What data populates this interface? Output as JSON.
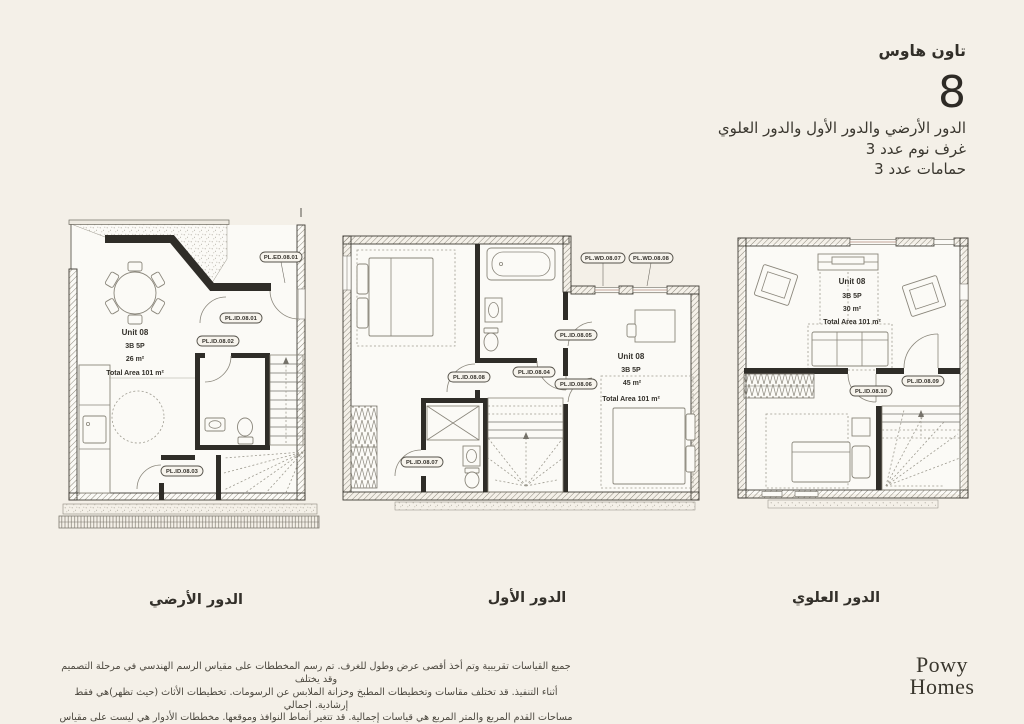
{
  "header": {
    "title": "تاون هاوس",
    "unit_number": "8",
    "floors": "الدور الأرضي والدور الأول والدور العلوي",
    "bedrooms": "غرف نوم عدد 3",
    "bathrooms": "حمامات عدد 3"
  },
  "plans": [
    {
      "label": "الدور الأرضي",
      "unit": "Unit 08",
      "type": "3B 5P",
      "area": "26 m²",
      "total": "Total Area 101 m²",
      "tags": [
        "PL.ED.08.01",
        "PL.ID.08.01",
        "PL.ID.08.02",
        "PL.ID.08.03"
      ]
    },
    {
      "label": "الدور الأول",
      "unit": "Unit 08",
      "type": "3B 5P",
      "area": "45 m²",
      "total": "Total Area 101 m²",
      "tags": [
        "PL.WD.08.07",
        "PL.WD.08.08",
        "PL.ID.08.05",
        "PL.ID.08.04",
        "PL.ID.08.06",
        "PL.ID.08.08",
        "PL.ID.08.07"
      ]
    },
    {
      "label": "الدور العلوي",
      "unit": "Unit 08",
      "type": "3B 5P",
      "area": "30 m²",
      "total": "Total Area 101 m²",
      "tags": [
        "PL.ID.08.09",
        "PL.ID.08.10"
      ]
    }
  ],
  "disclaimer": {
    "line1": "جميع القياسات تقريبية وتم أخذ أقصى عرض وطول للغرف. تم رسم المخططات على مقياس الرسم الهندسي في مرحلة التصميم وقد يختلف",
    "line2": "أثناء التنفيذ. قد تختلف مقاسات وتخطيطات المطبخ وخزانة الملابس عن الرسومات. تخطيطات الأثاث (حيث تظهر)هي فقط إرشادية. اجمالي",
    "line3": "مساحات القدم المربع والمتر المربع هي قياسات إجمالية. قد تتغير أنماط النوافذ وموقعها. مخططات الأدوار هي ليست على مقياس الرسم."
  },
  "logo": {
    "line1": "Powy",
    "line2": "Homes"
  },
  "colors": {
    "background": "#f4f0e8",
    "wall": "#2f2d28",
    "plan_fill": "#fbfaf6",
    "line": "#8a867b",
    "text": "#33302a"
  }
}
